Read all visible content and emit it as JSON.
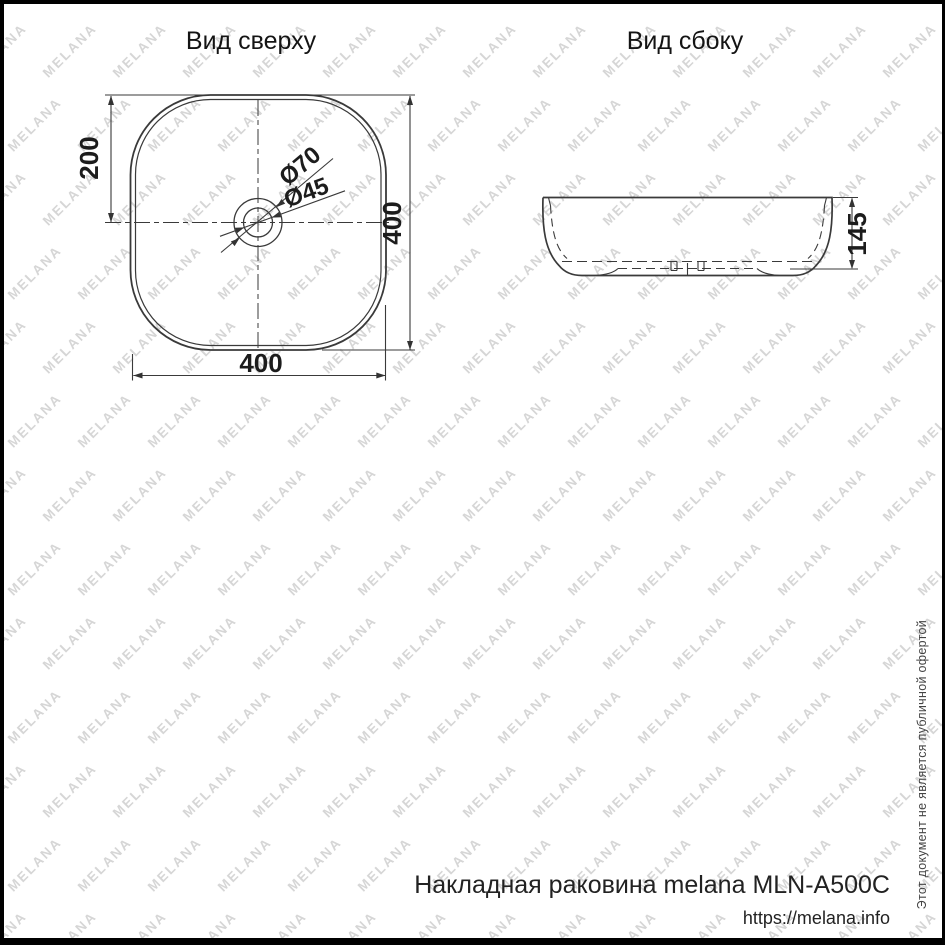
{
  "page": {
    "background": "#ffffff",
    "frame_color": "#000000"
  },
  "watermark": {
    "text": "MELANA",
    "color": "#d6d6d6",
    "font_size": 13.5,
    "col_spacing": 70,
    "row_spacing": 74,
    "row_offset": 35,
    "angle_deg": -45
  },
  "views": {
    "top": {
      "title": "Вид сверху",
      "dims": {
        "center_offset": "200",
        "height": "400",
        "width": "400",
        "drain_outer": "Ø70",
        "drain_inner": "Ø45"
      }
    },
    "side": {
      "title": "Вид сбоку",
      "dims": {
        "height": "145"
      }
    }
  },
  "footer": {
    "product": "Накладная раковина melana MLN-A500C",
    "url": "https://melana.info",
    "disclaimer": "Этот документ не является публичной офертой"
  },
  "colors": {
    "line": "#3a3a3a",
    "text": "#1c1c1c"
  }
}
